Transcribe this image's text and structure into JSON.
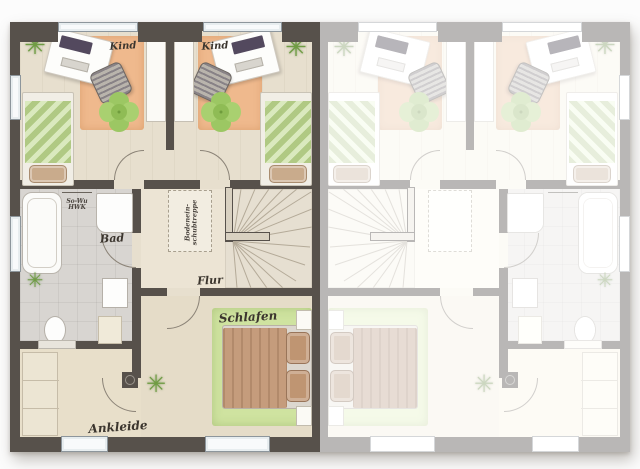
{
  "floorplan": {
    "description": "Obergeschoss Doppelhaus floor plan, left unit colored, right unit mirrored and faded",
    "rooms": {
      "kind_left": {
        "label": "Kind"
      },
      "kind_right": {
        "label": "Kind"
      },
      "bad": {
        "label": "Bad"
      },
      "flur": {
        "label": "Flur"
      },
      "schlafen": {
        "label": "Schlafen"
      },
      "ankleide": {
        "label": "Ankleide"
      }
    },
    "annotations": {
      "attic_stairs": {
        "line1": "Bodenein-",
        "line2": "schubtreppe"
      },
      "utility": {
        "line1": "So-Wu",
        "line2": "HWK"
      }
    }
  },
  "colors": {
    "wall": "#57514b",
    "floor": "#e7dfce",
    "tile": "#d8d5d1",
    "rugPeach": "#efb98d",
    "rugGreen": "#cfe3a0",
    "bedGreen": "#c6dd9b",
    "poufGreen": "#9cc763",
    "blanketTan": "#c59c7c",
    "pillowTan": "#bf9572",
    "stairs": "#e6dfd1",
    "window": "#f8fafb",
    "plant": "#6f9c43",
    "label": "#3b352e"
  }
}
